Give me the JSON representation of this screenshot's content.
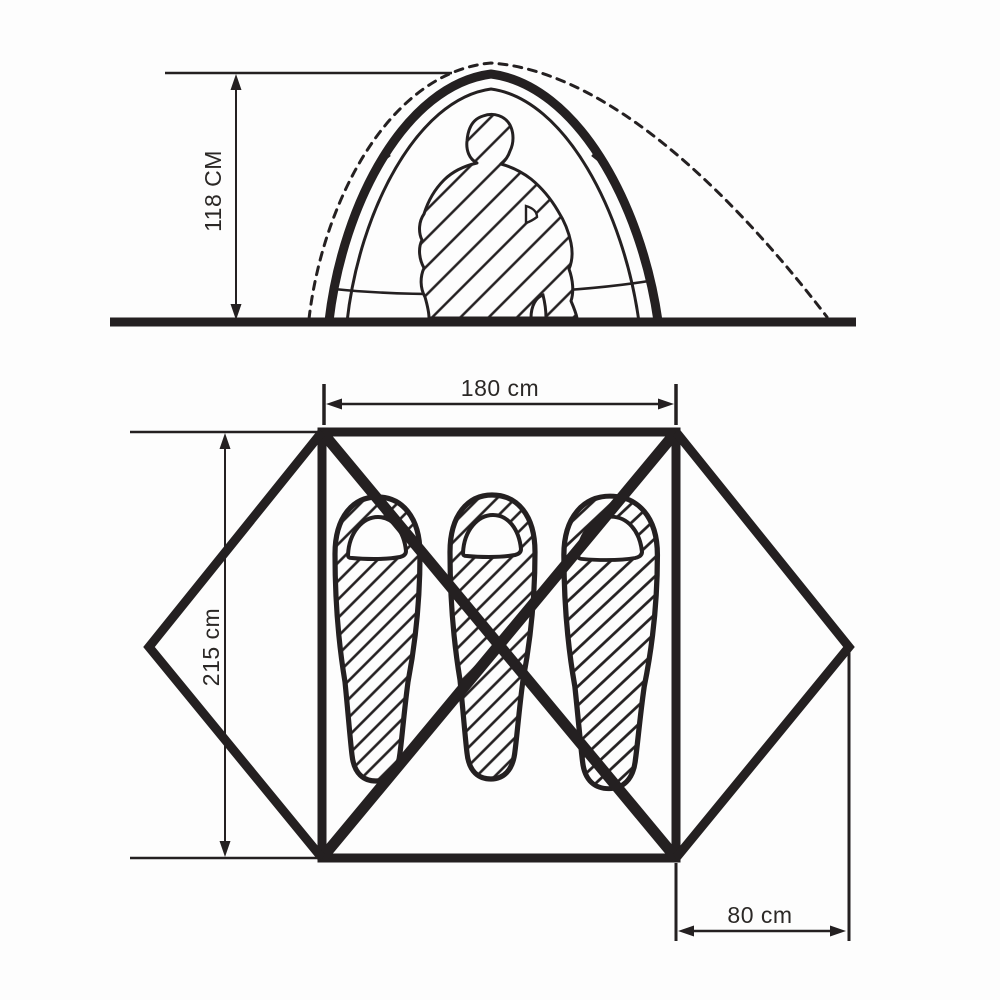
{
  "diagram": {
    "kind": "tent-specification-diagram",
    "side_view": {
      "height_label": "118 CM",
      "height_cm": 118
    },
    "floor_plan": {
      "width_label": "180 cm",
      "width_cm": 180,
      "length_label": "215 cm",
      "length_cm": 215,
      "vestibule_label": "80 cm",
      "vestibule_cm": 80,
      "sleeping_bag_count": 3
    },
    "colors": {
      "line": "#242021",
      "background": "#fdfdfd"
    }
  }
}
